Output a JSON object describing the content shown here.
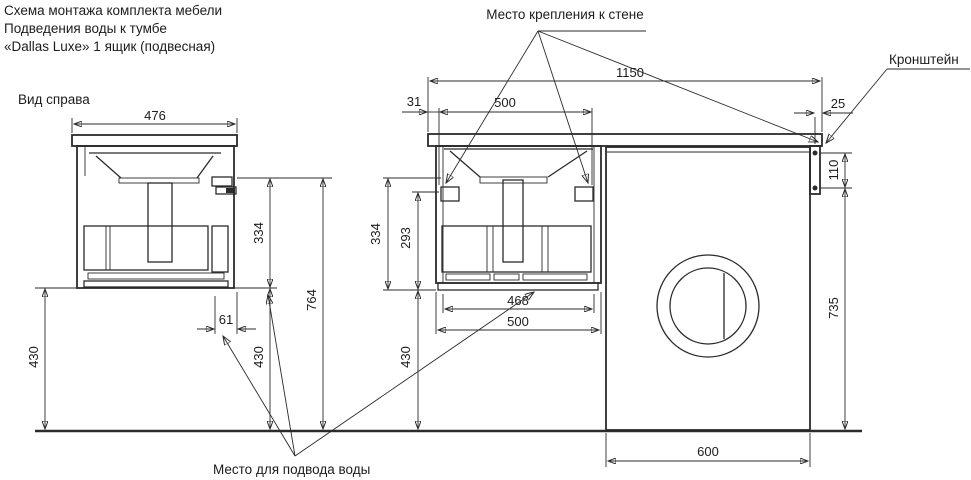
{
  "title": {
    "line1": "Схема монтажа комплекта мебели",
    "line2": "Подведения воды к тумбе",
    "line3": "«Dallas Luxe» 1 ящик (подвесная)"
  },
  "labels": {
    "view_right": "Вид справа",
    "wall_mount": "Место крепления к стене",
    "bracket": "Кронштейн",
    "water_supply": "Место для подвода воды"
  },
  "dims": {
    "side_depth": "476",
    "side_mount_height": "334",
    "side_total_height": "764",
    "side_water_offset": "61",
    "side_clearance_left": "430",
    "side_clearance_right": "430",
    "front_total_width": "1150",
    "front_edge_offset": "31",
    "front_mount_spacing": "500",
    "front_top_overhang": "25",
    "front_bracket_holes": "110",
    "front_mount_height": "334",
    "front_inner_height": "293",
    "front_drawer_width": "468",
    "front_cabinet_width": "500",
    "front_clearance": "430",
    "front_bracket_floor": "735",
    "front_washer_width": "600"
  },
  "colors": {
    "line": "#2b2b2b",
    "text": "#1c1c1c",
    "background": "#ffffff"
  }
}
